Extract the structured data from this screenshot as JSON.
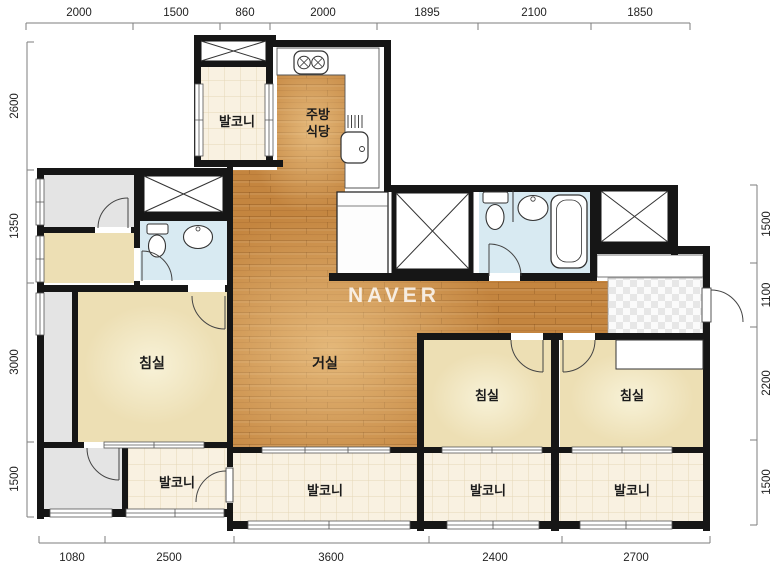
{
  "watermark": "NAVER",
  "rulers": {
    "top": [
      "2000",
      "1500",
      "860",
      "2000",
      "1895",
      "2100",
      "1850"
    ],
    "bottom": [
      "1080",
      "2500",
      "3600",
      "2400",
      "2700"
    ],
    "left": [
      "2600",
      "1350",
      "3000",
      "1500"
    ],
    "right": [
      "1500",
      "1100",
      "2200",
      "1500"
    ]
  },
  "rooms": {
    "balcony_top": "발코니",
    "kitchen_line1": "주방",
    "kitchen_line2": "식당",
    "living": "거실",
    "bedroom_main": "침실",
    "bedroom_2": "침실",
    "bedroom_3": "침실",
    "balcony_left": "발코니",
    "balcony_center": "발코니",
    "balcony_right1": "발코니",
    "balcony_right2": "발코니"
  },
  "icons": {
    "stove": "stove-burners-icon",
    "kitchen_sink": "kitchen-sink-icon",
    "dish_rack": "dish-rack-icon",
    "toilet": "toilet-icon",
    "washbasin": "washbasin-icon",
    "bathtub": "bathtub-icon",
    "shaft": "shaft-x-icon",
    "door": "door-arc-icon",
    "window": "window-icon",
    "entrance": "entrance-checker"
  },
  "colors": {
    "wood": "#c4853f",
    "cream": "#eddfb4",
    "tile": "#f9f1e1",
    "gray": "#e4e4e4",
    "bath_blue": "#d8eaf2",
    "wall": "#161616"
  }
}
